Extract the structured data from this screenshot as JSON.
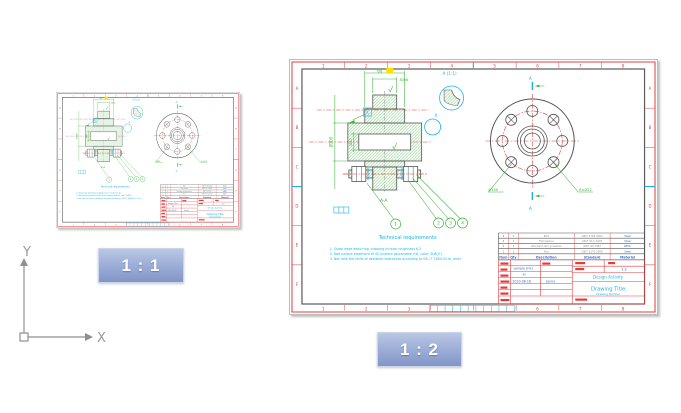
{
  "badges": {
    "left": "1 : 1",
    "right": "1 : 2"
  },
  "ucs": {
    "x_label": "X",
    "y_label": "Y"
  },
  "colors": {
    "red": "#e23c3c",
    "green": "#3cb43c",
    "cyan": "#18b4e8",
    "blue": "#3a6cc8",
    "yellow": "#ffe000",
    "dark": "#555555",
    "badge_top": "#bac7e4",
    "badge_bottom": "#8295c6"
  },
  "sheet": {
    "zones_top": [
      "1",
      "2",
      "3",
      "4",
      "5",
      "6",
      "7",
      "8"
    ],
    "zones_side": [
      "A",
      "B",
      "C",
      "D",
      "E",
      "F"
    ],
    "view": {
      "dim_width": "60",
      "dim_hub": "30h6",
      "dim_outer": "Ø100",
      "dim_bore": "Ø40",
      "datum_label": "A",
      "detail_ref_label": "A",
      "detail_view_label": "A (1:1)",
      "section_mark_top": "A",
      "section_mark_bottom": "A",
      "section_view_label": "A-A",
      "flange_bolt_circle": "Ø140",
      "flange_holes": "8×Ø22",
      "balloons": [
        "1",
        "2",
        "3",
        "4"
      ]
    },
    "tech_req": {
      "title": "Technical requirements",
      "lines": [
        "1. Sharp edge deburring, chipping incision roughness 6.3",
        "2. Rod surface treatment of 45 (surface galvanized) full, color: Zn8(JC)",
        "3. Not note the limits of deviation tolerances according to GB / T 1804-92 m, level"
      ]
    },
    "parts_list": {
      "headers": [
        "Item",
        "Qty",
        "Description",
        "Standard",
        "Material"
      ],
      "rows": [
        {
          "item": "4",
          "qty": "1",
          "description": "Bolt",
          "standard": "GB/T 5782-2000",
          "material": "Steel"
        },
        {
          "item": "3",
          "qty": "1",
          "description": "Flat washer",
          "standard": "GB/T 97.1-2002",
          "material": "Steel"
        },
        {
          "item": "2",
          "qty": "1",
          "description": "Standard spring washer",
          "standard": "GB/T 93-1987",
          "material": "65Mn"
        },
        {
          "item": "1",
          "qty": "1",
          "description": "Nut",
          "standard": "GB/T 6170-2000",
          "material": "Steel"
        }
      ]
    },
    "title_block": {
      "part_name": "sample (Fix)",
      "material": "45",
      "date": "2010-08-16",
      "author": "Jenny",
      "scale": "1:2",
      "company": "Design Activity",
      "drawing_title": "Drawing Title",
      "drawing_number": "Drawing Number"
    }
  }
}
